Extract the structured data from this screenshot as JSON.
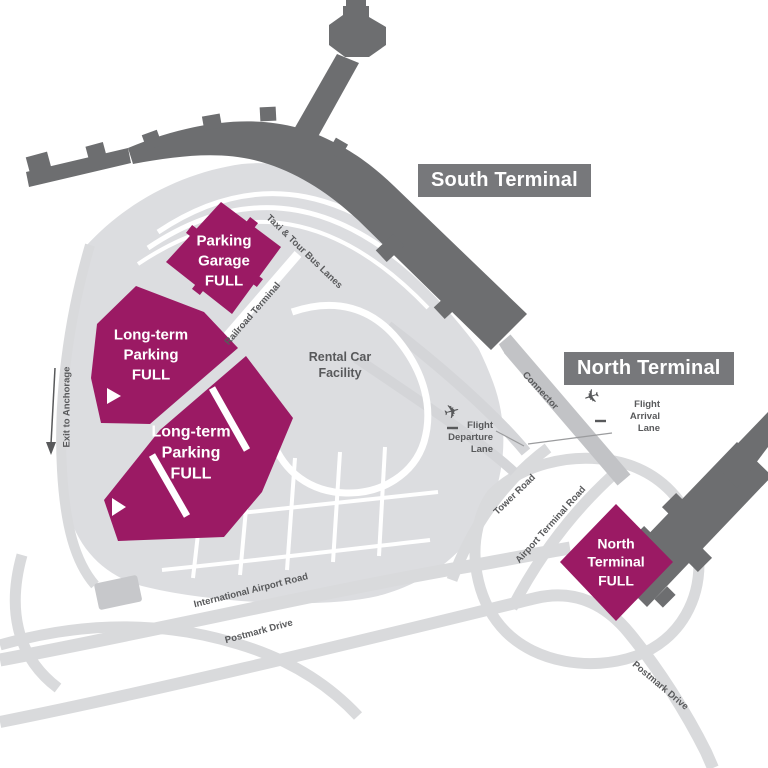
{
  "terminals": {
    "south": {
      "label": "South Terminal"
    },
    "north": {
      "label": "North Terminal"
    }
  },
  "zones": {
    "parking_garage": {
      "label": "Parking\nGarage\nFULL",
      "status": "FULL"
    },
    "long_term_upper": {
      "label": "Long-term\nParking\nFULL",
      "status": "FULL"
    },
    "long_term_lower": {
      "label": "Long-term\nParking\nFULL",
      "status": "FULL"
    },
    "north_terminal_lot": {
      "label": "North\nTerminal\nFULL",
      "status": "FULL"
    },
    "rental_car": {
      "label": "Rental Car\nFacility"
    }
  },
  "roads": {
    "taxi_tour_bus": "Taxi & Tour Bus Lanes",
    "railroad_terminal": "Railroad Terminal",
    "connector": "Connector",
    "tower_road": "Tower Road",
    "airport_terminal_road": "Airport Terminal Road",
    "international_airport_road": "International Airport Road",
    "postmark_drive_west": "Postmark Drive",
    "postmark_drive_south": "Postmark Drive",
    "exit_to_anchorage": "Exit to Anchorage"
  },
  "lanes": {
    "departure": {
      "label": "Flight\nDeparture\nLane",
      "icon": "plane-takeoff-icon"
    },
    "arrival": {
      "label": "Flight\nArrival\nLane",
      "icon": "plane-landing-icon"
    }
  },
  "colors": {
    "full_lot": "#9b1a64",
    "building": "#6d6e70",
    "label_box": "#77787b",
    "ground": "#dcdde0",
    "road_text": "#58595b"
  }
}
